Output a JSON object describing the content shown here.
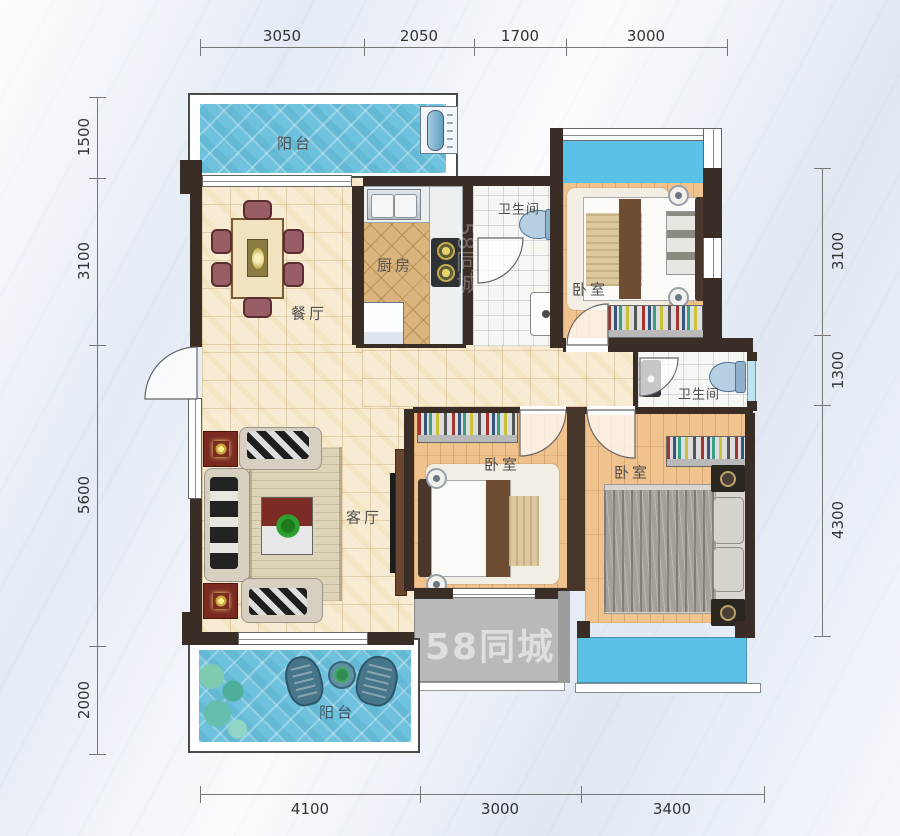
{
  "plan": {
    "room_labels": {
      "balcony_top": "阳台",
      "dining": "餐厅",
      "kitchen": "厨房",
      "bath_top": "卫生间",
      "bedroom_top": "卧室",
      "bath_mid": "卫生间",
      "bedroom_mid": "卧室",
      "bedroom_right": "卧室",
      "living": "客厅",
      "balcony_bottom": "阳台"
    },
    "dimensions": {
      "top": [
        "3050",
        "2050",
        "1700",
        "3000"
      ],
      "bottom": [
        "4100",
        "3000",
        "3400"
      ],
      "left": [
        "1500",
        "3100",
        "5600",
        "2000"
      ],
      "right": [
        "3100",
        "1300",
        "4300"
      ]
    },
    "watermark": "58同城",
    "colors": {
      "wall": "#3a2d25",
      "balcony_tile": "#6ec2de",
      "window_glass": "#5bc1e6",
      "wood_floor": "#efc28e",
      "cream_tile": "#f7ecd3",
      "kitchen_tile": "#d9b47c",
      "platform_gray": "#b9b9b9"
    }
  }
}
